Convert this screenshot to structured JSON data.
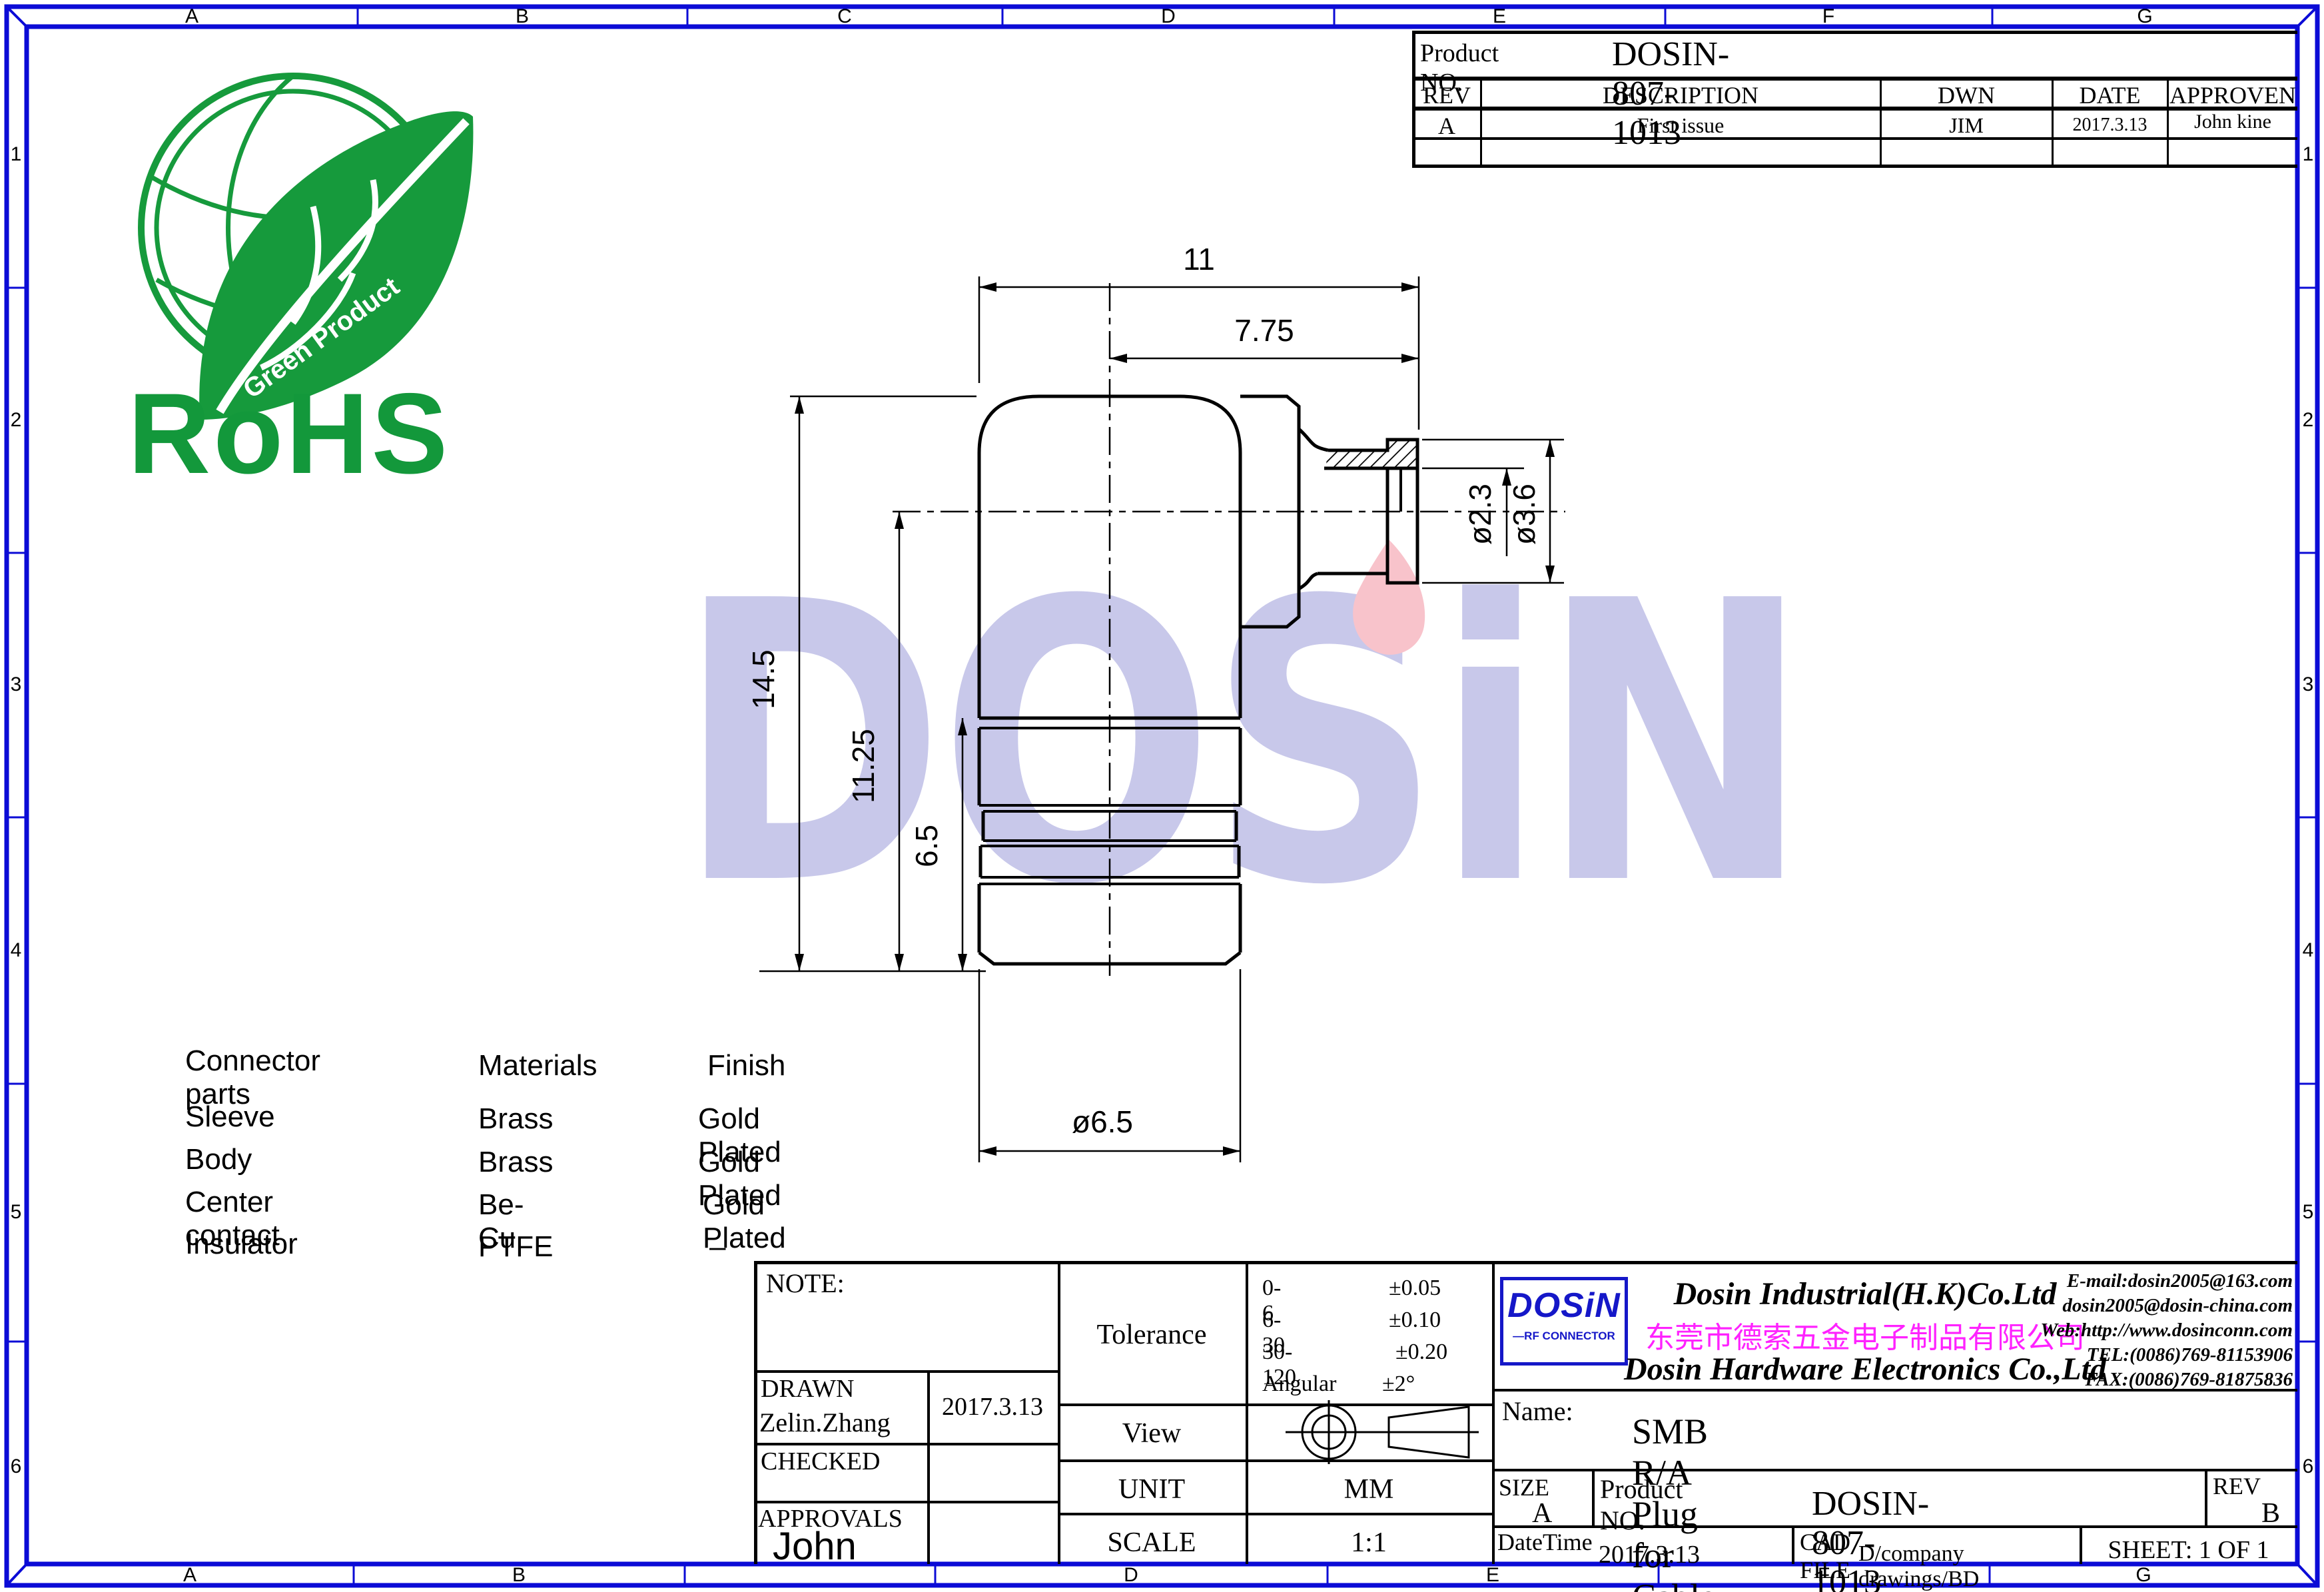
{
  "frame": {
    "top": [
      "A",
      "B",
      "C",
      "D",
      "E",
      "F",
      "G"
    ],
    "bottom": [
      "A",
      "B",
      "",
      "D",
      "E",
      "F",
      "G"
    ],
    "left": [
      "1",
      "2",
      "3",
      "4",
      "5",
      "6"
    ],
    "right": [
      "1",
      "2",
      "3",
      "4",
      "5",
      "6"
    ]
  },
  "rohs": {
    "text": "RoHS",
    "arc_text": "Green Product"
  },
  "watermark": {
    "text": "DOSiN"
  },
  "revision_table": {
    "product_no_label": "Product NO.",
    "product_no": "DOSIN-807-1013",
    "headers": [
      "REV",
      "DESCRIPTION",
      "DWN",
      "DATE",
      "APPROVEN"
    ],
    "rows": [
      [
        "A",
        "First issue",
        "JIM",
        "2017.3.13",
        "John kine"
      ]
    ]
  },
  "drawing": {
    "dims": {
      "width_total": "11",
      "width_to_center": "7.75",
      "height_total": "14.5",
      "height_to_center": "11.25",
      "height_lower": "6.5",
      "dia_body": "ø6.5",
      "dia_contact": "ø2.3",
      "dia_barrel": "ø3.6"
    }
  },
  "materials": {
    "headers": [
      "Connector parts",
      "Materials",
      "Finish"
    ],
    "rows": [
      [
        "Sleeve",
        "Brass",
        "Gold Plated"
      ],
      [
        "Body",
        "Brass",
        "Gold Plated"
      ],
      [
        "Center contact",
        "Be-Cu",
        "Gold Plated"
      ],
      [
        "Insulator",
        "PTFE",
        "–"
      ]
    ]
  },
  "title_block": {
    "note_label": "NOTE:",
    "drawn_label": "DRAWN",
    "drawn_name": "Zelin.Zhang",
    "drawn_date": "2017.3.13",
    "checked_label": "CHECKED",
    "approvals_label": "APPROVALS",
    "approvals_signature": "John",
    "tolerance_label": "Tolerance",
    "tolerance_rows": [
      [
        "0-6",
        "±0.05"
      ],
      [
        "6-30",
        "±0.10"
      ],
      [
        "30-120",
        "±0.20"
      ],
      [
        "Angular",
        "±2°"
      ]
    ],
    "view_label": "View",
    "unit_label": "UNIT",
    "unit_value": "MM",
    "scale_label": "SCALE",
    "scale_value": "1:1"
  },
  "company": {
    "logo_text": "DOSiN",
    "logo_subtext": "—RF CONNECTOR",
    "name_hk": "Dosin Industrial(H.K)Co.Ltd",
    "name_cn": "东莞市德索五金电子制品有限公司",
    "name_hw": "Dosin Hardware Electronics  Co.,Ltd",
    "contact_lines": [
      "E-mail:dosin2005@163.com",
      "dosin2005@dosin-china.com",
      "Web:http://www.dosinconn.com",
      "TEL:(0086)769-81153906",
      "FAX:(0086)769-81875836"
    ]
  },
  "product": {
    "name_label": "Name:",
    "name": "SMB R/A Plug for Cable UT085",
    "size_label": "SIZE",
    "size": "A",
    "product_no_label": "Product NO.",
    "product_no": "DOSIN-807-1013",
    "rev_label": "REV",
    "rev": "B",
    "datetime_label": "DateTime",
    "datetime": "2017.3.13",
    "cad_file_label": "CAD FILE",
    "cad_file": "D/company drawings/BD",
    "sheet": "SHEET:  1 OF 1"
  },
  "colors": {
    "frame_blue": "#0b0bd6",
    "rohs_green": "#169a3c",
    "watermark_blue": "#c8c8ea",
    "flame_pink": "#f8c3cb",
    "company_magenta": "#ff22ff",
    "logo_blue": "#1517c8"
  }
}
